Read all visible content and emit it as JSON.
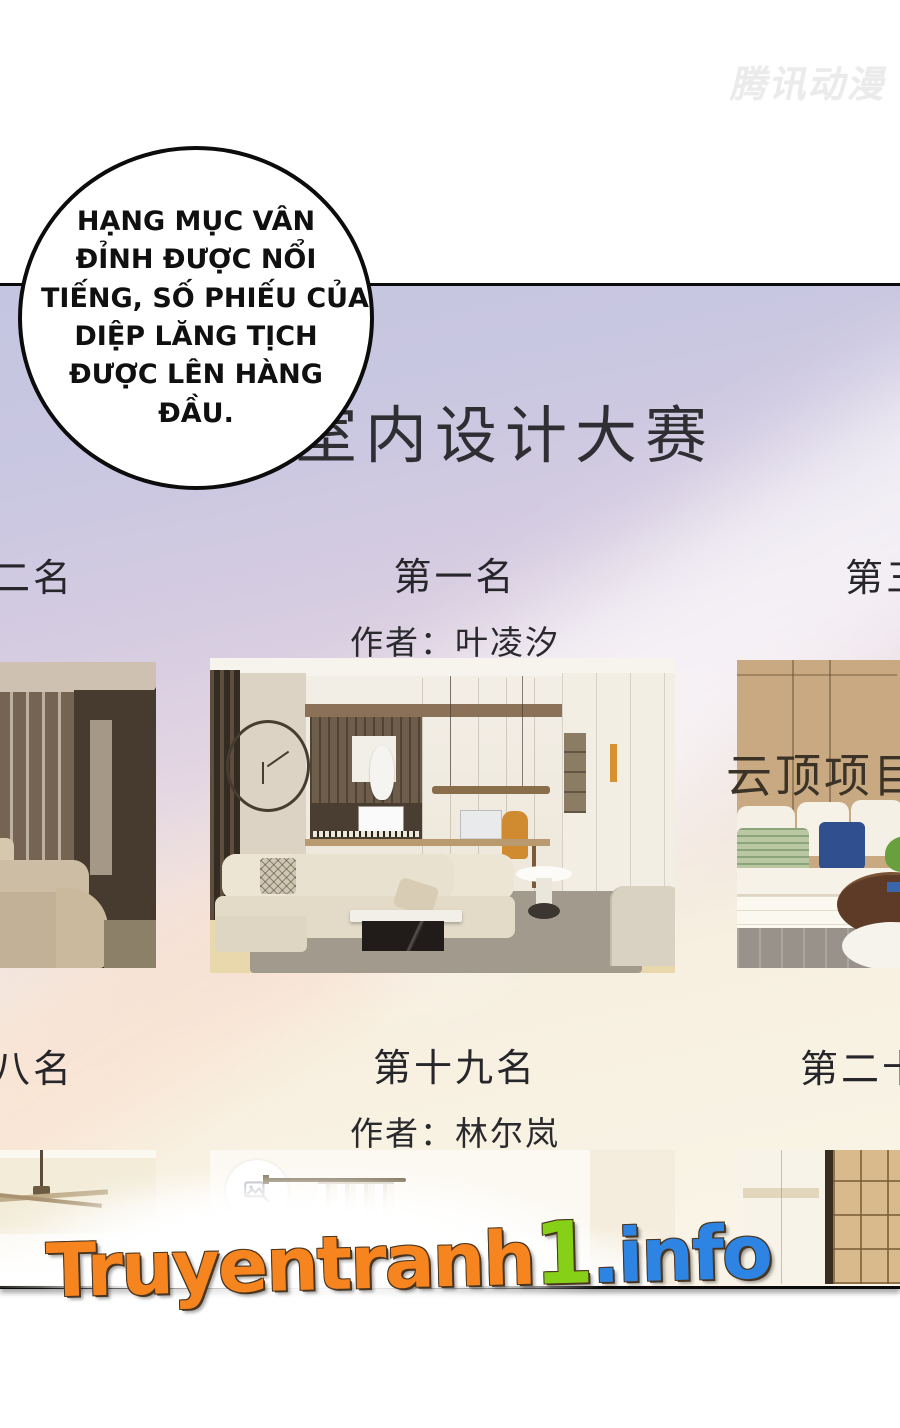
{
  "page": {
    "publisher_watermark": "腾讯动漫",
    "site_watermark": {
      "part1": "Truyentranh",
      "part2": "1",
      "part3": ".info",
      "color_orange": "#f6851f",
      "color_green": "#86d018",
      "color_blue": "#2d84e2"
    }
  },
  "speech_bubble": {
    "lines": [
      "HẠNG MỤC VÂN",
      "ĐỈNH ĐƯỢC NỔI",
      "TIẾNG, SỐ PHIẾU CỦA",
      "DIỆP LĂNG TỊCH",
      "ĐƯỢC LÊN HÀNG",
      "ĐẦU."
    ]
  },
  "panel": {
    "title": "室内设计大赛",
    "overlay_caption": "云顶项目被",
    "background_colors": {
      "top": "#c4c5e1",
      "middle": "#e3d5e2",
      "bottom": "#faf5e8"
    },
    "row1": {
      "left_rank_partial": "二名",
      "center_rank": "第一名",
      "center_author": "作者：叶凌汐",
      "right_rank_partial": "第三"
    },
    "row2": {
      "left_rank_partial": "八名",
      "center_rank": "第十九名",
      "center_author": "作者：林尔岚",
      "right_rank_partial": "第二十"
    }
  }
}
